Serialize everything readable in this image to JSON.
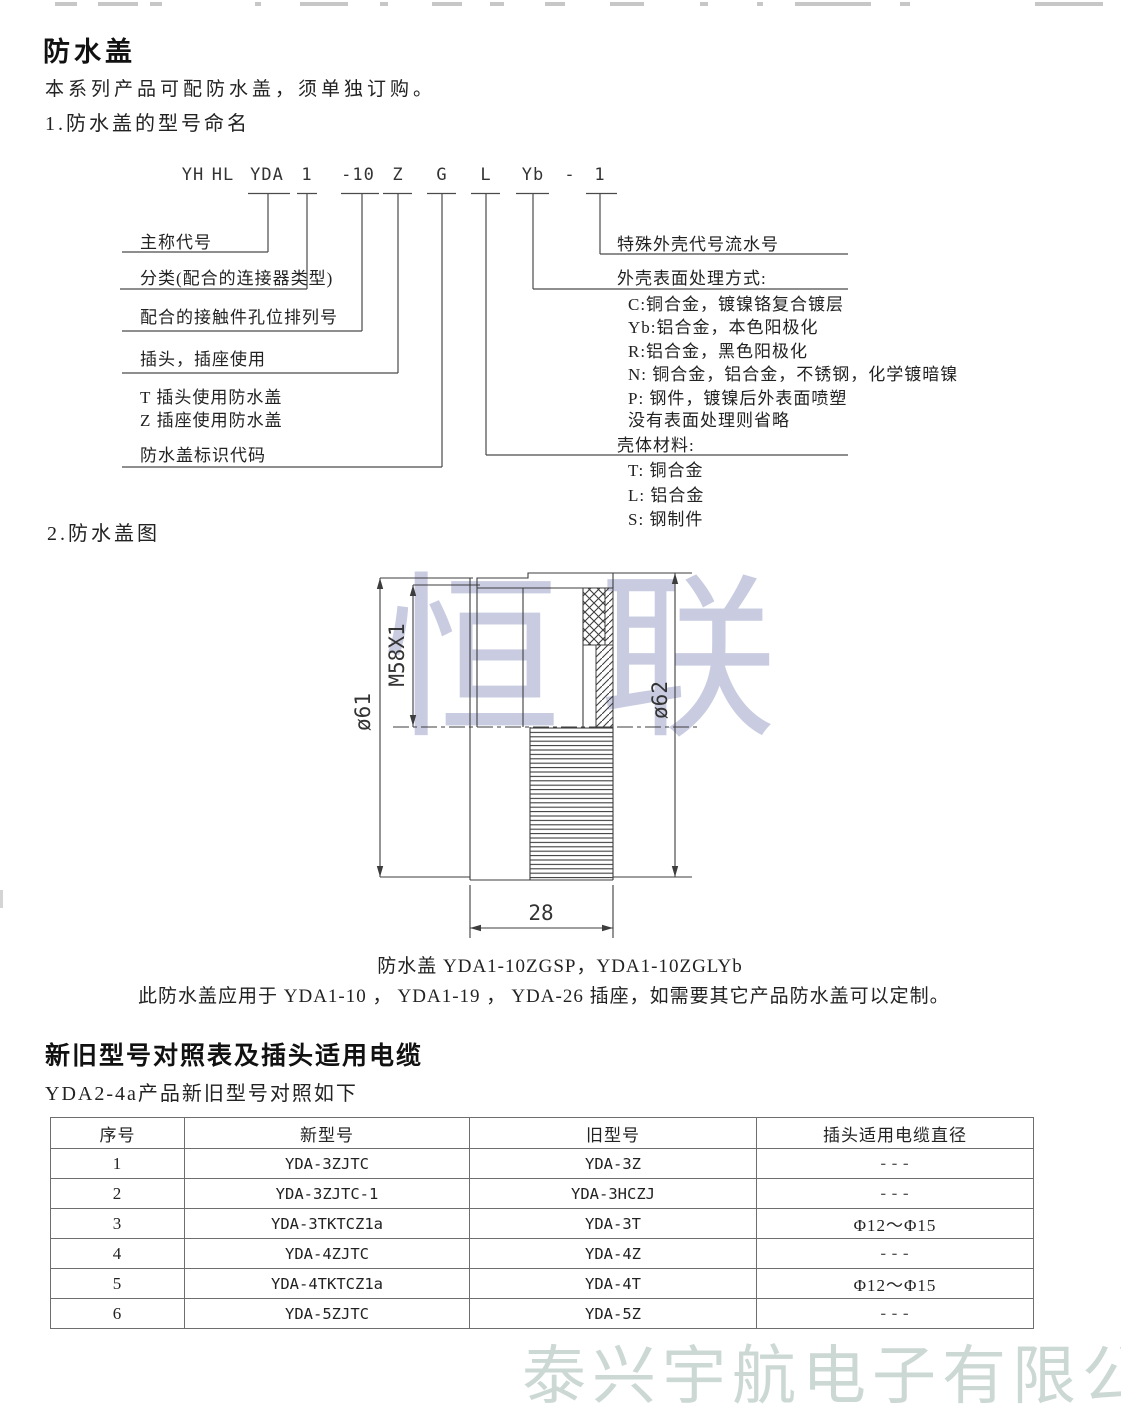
{
  "section1": {
    "heading": "防水盖",
    "intro": "本系列产品可配防水盖，须单独订购。",
    "subheading": "1.防水盖的型号命名",
    "code_parts": [
      "YH",
      "HL",
      "YDA",
      "1",
      "-10",
      "Z",
      "G",
      "L",
      "Yb",
      "-",
      "1"
    ],
    "left_labels": [
      "主称代号",
      "分类(配合的连接器类型)",
      "配合的接触件孔位排列号",
      "插头，插座使用",
      "T 插头使用防水盖",
      "Z 插座使用防水盖",
      "防水盖标识代码"
    ],
    "right_labels": [
      "特殊外壳代号流水号",
      "外壳表面处理方式:",
      "C:铜合金，镀镍铬复合镀层",
      "Yb:铝合金，本色阳极化",
      "R:铝合金，黑色阳极化",
      "N: 铜合金，铝合金，不锈钢，化学镀暗镍",
      "P: 钢件，镀镍后外表面喷塑",
      "没有表面处理则省略",
      "壳体材料:",
      "T: 铜合金",
      "L: 铝合金",
      "S: 钢制件"
    ]
  },
  "section2": {
    "subheading": "2.防水盖图",
    "dims": {
      "left_diameter": "ø61",
      "thread": "M58X1",
      "right_diameter": "ø62",
      "width": "28"
    },
    "caption_line1": "防水盖 YDA1-10ZGSP，YDA1-10ZGLYb",
    "caption_line2": "此防水盖应用于 YDA1-10 ， YDA1-19 ， YDA-26 插座，如需要其它产品防水盖可以定制。"
  },
  "section3": {
    "heading": "新旧型号对照表及插头适用电缆",
    "subheading": "YDA2-4a产品新旧型号对照如下",
    "table": {
      "headers": [
        "序号",
        "新型号",
        "旧型号",
        "插头适用电缆直径"
      ],
      "rows": [
        [
          "1",
          "YDA-3ZJTC",
          "YDA-3Z",
          "---"
        ],
        [
          "2",
          "YDA-3ZJTC-1",
          "YDA-3HCZJ",
          "---"
        ],
        [
          "3",
          "YDA-3TKTCZ1a",
          "YDA-3T",
          "Φ12～Φ15"
        ],
        [
          "4",
          "YDA-4ZJTC",
          "YDA-4Z",
          "---"
        ],
        [
          "5",
          "YDA-4TKTCZ1a",
          "YDA-4T",
          "Φ12～Φ15"
        ],
        [
          "6",
          "YDA-5ZJTC",
          "YDA-5Z",
          "---"
        ]
      ]
    }
  },
  "watermarks": {
    "drawing_text": "恒联",
    "drawing_color": "#c9cce1",
    "footer_text": "泰兴宇航电子有限公司",
    "footer_color": "#ccd8d4"
  }
}
